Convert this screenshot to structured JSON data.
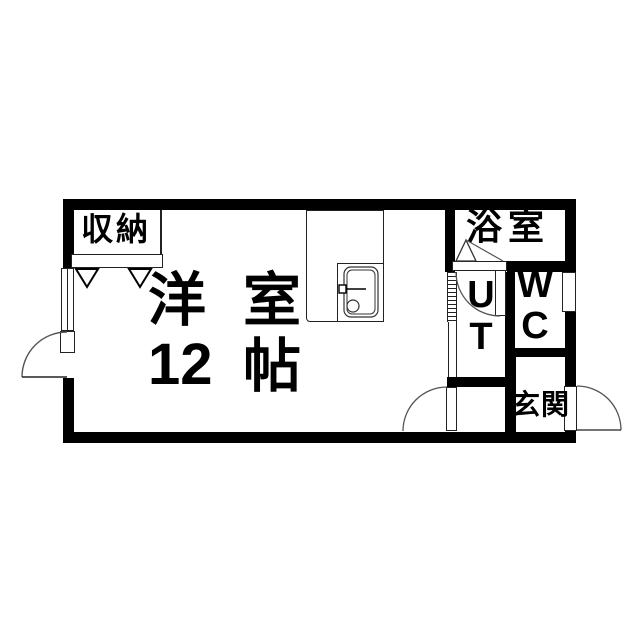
{
  "colors": {
    "wall": "#000000",
    "background": "#ffffff",
    "line": "#222222"
  },
  "rooms": {
    "closet": {
      "label": "収納"
    },
    "main": {
      "full_label": "洋室 12帖",
      "name_c1": "洋",
      "name_c2": "室",
      "size_num": "12",
      "size_unit": "帖"
    },
    "bathroom": {
      "label": "浴室"
    },
    "utility": {
      "line1": "U",
      "line2": "T",
      "full_label": "UT"
    },
    "toilet": {
      "line1": "W",
      "line2": "C",
      "full_label": "WC"
    },
    "entrance": {
      "label": "玄関"
    }
  },
  "fixtures": {
    "kitchen_sink": "sink",
    "closet_doors": "folding-doors",
    "bathroom_door": "folding-door",
    "left_wall": "window-and-door",
    "entrance_door": "outward-swing-door"
  }
}
